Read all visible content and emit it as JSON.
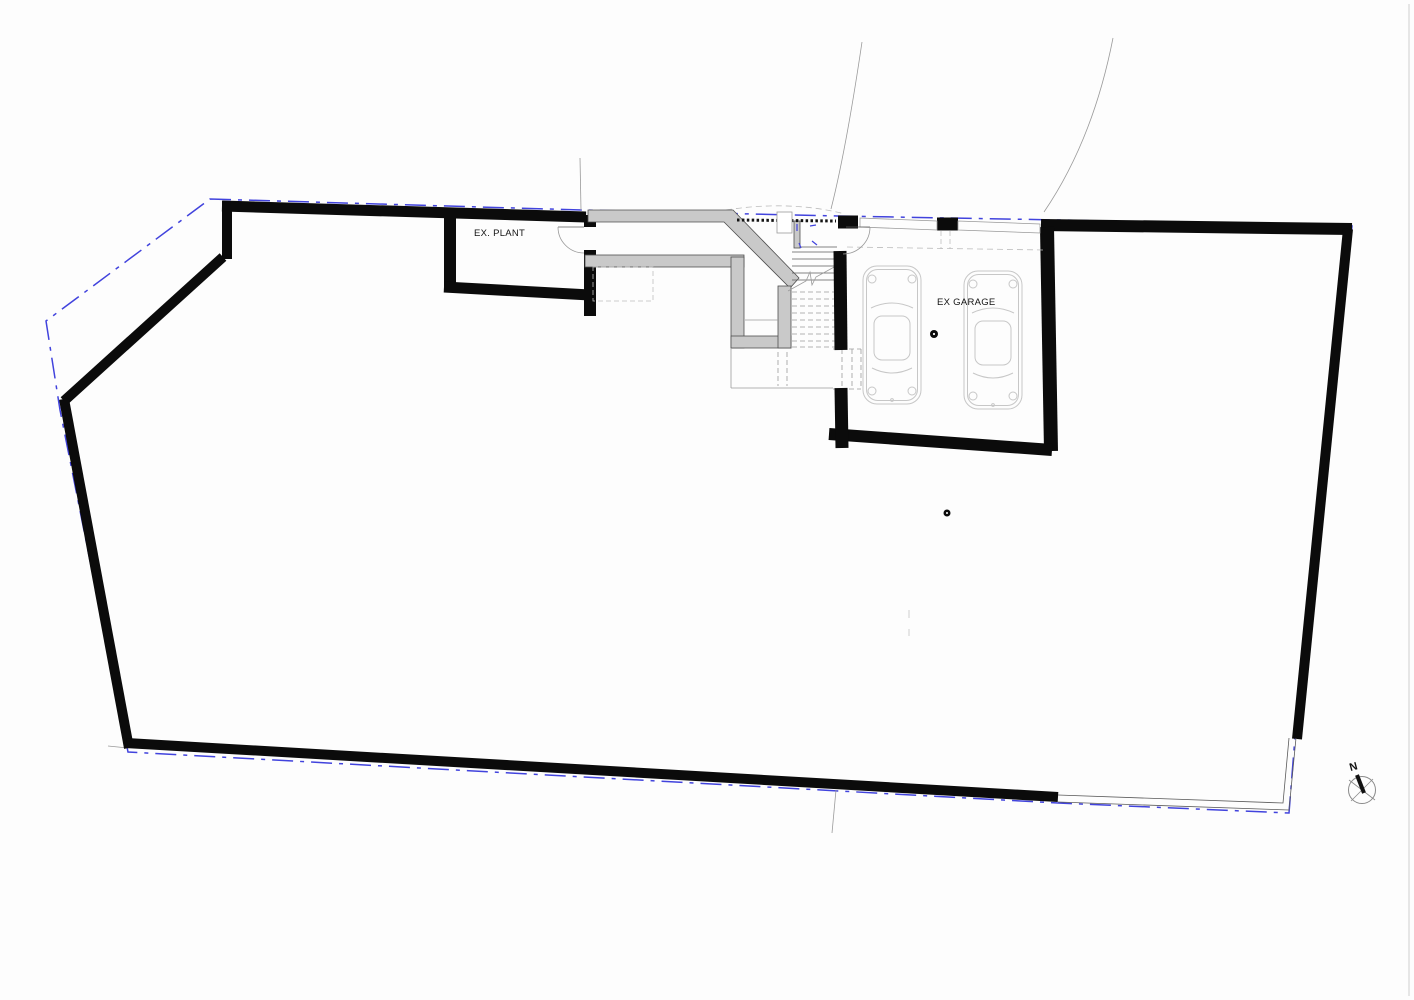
{
  "drawing": {
    "type": "architectural-floor-plan",
    "labels": {
      "plant_room": "EX. PLANT",
      "garage": "EX GARAGE",
      "north": "N"
    },
    "colors": {
      "cut_wall": "#0b0b0b",
      "existing_wall_fill": "#c9c9c9",
      "existing_wall_outline": "#4f4f4f",
      "site_boundary_blue": "#4143dd",
      "thin_line": "#5a5a5a",
      "hidden_dashed": "#9a9a9a",
      "car_outline": "#c7c7c7",
      "background": "#fdfdfd"
    },
    "symbols": {
      "north_arrow": "compass-circle-with-needle",
      "columns": 2,
      "cars": 2
    }
  }
}
